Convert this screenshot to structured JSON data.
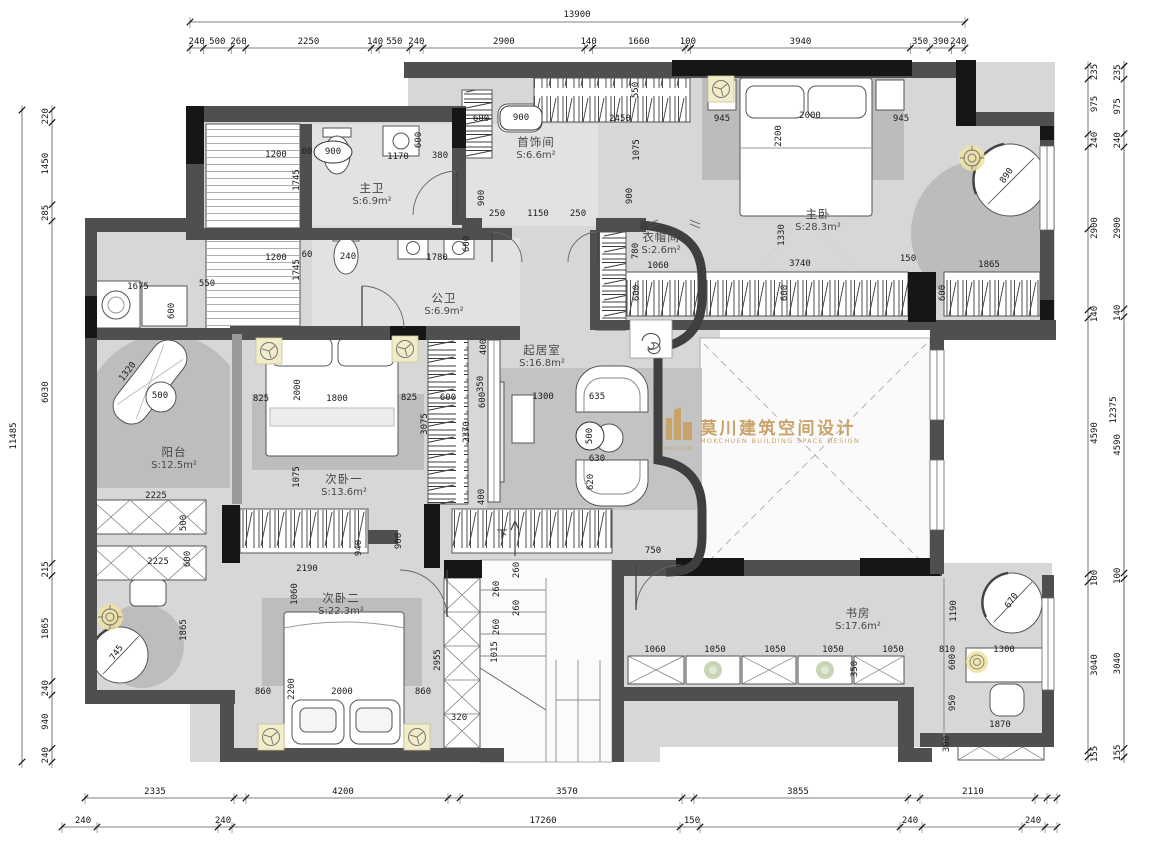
{
  "watermark": {
    "cn": "莫川建筑空间设计",
    "en": "MOKCHUEN BUILDING SPACE DESIGN",
    "logo_text": "MOKCHUEN",
    "color": "#c9a36a"
  },
  "stair_label": "下",
  "rooms": [
    {
      "name": "主卫",
      "area": "S:6.9m²",
      "x": 372,
      "y": 195
    },
    {
      "name": "首饰间",
      "area": "S:6.6m²",
      "x": 536,
      "y": 149
    },
    {
      "name": "主卧",
      "area": "S:28.3m²",
      "x": 818,
      "y": 221
    },
    {
      "name": "衣帽间",
      "area": "S:2.6m²",
      "x": 661,
      "y": 244
    },
    {
      "name": "公卫",
      "area": "S:6.9m²",
      "x": 444,
      "y": 305
    },
    {
      "name": "起居室",
      "area": "S:16.8m²",
      "x": 542,
      "y": 357
    },
    {
      "name": "阳台",
      "area": "S:12.5m²",
      "x": 174,
      "y": 459
    },
    {
      "name": "次卧一",
      "area": "S:13.6m²",
      "x": 344,
      "y": 486
    },
    {
      "name": "次卧二",
      "area": "S:22.3m²",
      "x": 341,
      "y": 605
    },
    {
      "name": "书房",
      "area": "S:17.6m²",
      "x": 858,
      "y": 620
    }
  ],
  "dims": {
    "top_total": "13900",
    "top": [
      "240",
      "500",
      "260",
      "2250",
      "140",
      "550",
      "240",
      "2900",
      "140",
      "1660",
      "100",
      "3940",
      "350",
      "390",
      "240"
    ],
    "left_total": "11485",
    "left": [
      "220",
      "1450",
      "285",
      "6030",
      "215",
      "1865",
      "240",
      "940",
      "240"
    ],
    "right_total": "12375",
    "right": [
      "235",
      "975",
      "240",
      "2900",
      "140",
      "4590",
      "100",
      "3040",
      "155"
    ],
    "bottom_row1": [
      {
        "t": "2335",
        "x": 155
      },
      {
        "t": "4200",
        "x": 343
      },
      {
        "t": "3570",
        "x": 567
      },
      {
        "t": "3855",
        "x": 798
      },
      {
        "t": "2110",
        "x": 973
      }
    ],
    "bottom_row2": [
      {
        "t": "240",
        "x": 83
      },
      {
        "t": "240",
        "x": 223
      },
      {
        "t": "17260",
        "x": 543
      },
      {
        "t": "150",
        "x": 692
      },
      {
        "t": "240",
        "x": 910
      },
      {
        "t": "240",
        "x": 1033
      }
    ]
  },
  "inner_dims": [
    {
      "t": "1200",
      "x": 276,
      "y": 155
    },
    {
      "t": "60",
      "x": 307,
      "y": 152
    },
    {
      "t": "900",
      "x": 333,
      "y": 152
    },
    {
      "t": "1170",
      "x": 398,
      "y": 157
    },
    {
      "t": "380",
      "x": 440,
      "y": 156
    },
    {
      "t": "600",
      "x": 419,
      "y": 140,
      "r": -90
    },
    {
      "t": "1745",
      "x": 297,
      "y": 180,
      "r": -90
    },
    {
      "t": "900",
      "x": 482,
      "y": 198,
      "r": -90
    },
    {
      "t": "250",
      "x": 497,
      "y": 214
    },
    {
      "t": "1150",
      "x": 538,
      "y": 214
    },
    {
      "t": "250",
      "x": 578,
      "y": 214
    },
    {
      "t": "600",
      "x": 481,
      "y": 119
    },
    {
      "t": "900",
      "x": 521,
      "y": 118
    },
    {
      "t": "2450",
      "x": 620,
      "y": 119
    },
    {
      "t": "550",
      "x": 636,
      "y": 90,
      "r": -90
    },
    {
      "t": "1075",
      "x": 637,
      "y": 150,
      "r": -90
    },
    {
      "t": "945",
      "x": 722,
      "y": 119
    },
    {
      "t": "2000",
      "x": 810,
      "y": 116
    },
    {
      "t": "945",
      "x": 901,
      "y": 119
    },
    {
      "t": "2200",
      "x": 779,
      "y": 136,
      "r": -90
    },
    {
      "t": "1200",
      "x": 276,
      "y": 258
    },
    {
      "t": "60",
      "x": 307,
      "y": 255
    },
    {
      "t": "240",
      "x": 348,
      "y": 257
    },
    {
      "t": "1780",
      "x": 437,
      "y": 258
    },
    {
      "t": "600",
      "x": 467,
      "y": 244,
      "r": -90
    },
    {
      "t": "1745",
      "x": 297,
      "y": 270,
      "r": -90
    },
    {
      "t": "1675",
      "x": 138,
      "y": 287
    },
    {
      "t": "550",
      "x": 207,
      "y": 284
    },
    {
      "t": "600",
      "x": 172,
      "y": 311,
      "r": -90
    },
    {
      "t": "900",
      "x": 630,
      "y": 196,
      "r": -90
    },
    {
      "t": "780",
      "x": 636,
      "y": 251,
      "r": -90
    },
    {
      "t": "1060",
      "x": 658,
      "y": 266
    },
    {
      "t": "1330",
      "x": 782,
      "y": 235,
      "r": -90
    },
    {
      "t": "3740",
      "x": 800,
      "y": 264
    },
    {
      "t": "150",
      "x": 908,
      "y": 259
    },
    {
      "t": "1865",
      "x": 989,
      "y": 265
    },
    {
      "t": "600",
      "x": 637,
      "y": 293,
      "r": -90
    },
    {
      "t": "600",
      "x": 785,
      "y": 293,
      "r": -90
    },
    {
      "t": "600",
      "x": 943,
      "y": 293,
      "r": -90
    },
    {
      "t": "890",
      "x": 1007,
      "y": 176,
      "r": -55
    },
    {
      "t": "400",
      "x": 484,
      "y": 347,
      "r": -90
    },
    {
      "t": "350",
      "x": 481,
      "y": 384,
      "r": -90
    },
    {
      "t": "825",
      "x": 409,
      "y": 398
    },
    {
      "t": "600",
      "x": 448,
      "y": 398
    },
    {
      "t": "600",
      "x": 483,
      "y": 400,
      "r": -90
    },
    {
      "t": "3075",
      "x": 425,
      "y": 424,
      "r": -90
    },
    {
      "t": "2370",
      "x": 467,
      "y": 432,
      "r": -90
    },
    {
      "t": "1300",
      "x": 543,
      "y": 397
    },
    {
      "t": "635",
      "x": 597,
      "y": 397
    },
    {
      "t": "500",
      "x": 590,
      "y": 436,
      "r": -90
    },
    {
      "t": "630",
      "x": 597,
      "y": 459
    },
    {
      "t": "620",
      "x": 591,
      "y": 482,
      "r": -90
    },
    {
      "t": "400",
      "x": 482,
      "y": 497,
      "r": -90
    },
    {
      "t": "1320",
      "x": 128,
      "y": 372,
      "r": -52
    },
    {
      "t": "500",
      "x": 160,
      "y": 396
    },
    {
      "t": "2225",
      "x": 156,
      "y": 496
    },
    {
      "t": "500",
      "x": 184,
      "y": 523,
      "r": -90
    },
    {
      "t": "2225",
      "x": 158,
      "y": 562
    },
    {
      "t": "600",
      "x": 188,
      "y": 559,
      "r": -90
    },
    {
      "t": "1865",
      "x": 184,
      "y": 630,
      "r": -90
    },
    {
      "t": "745",
      "x": 117,
      "y": 653,
      "r": -55
    },
    {
      "t": "825",
      "x": 261,
      "y": 399
    },
    {
      "t": "2000",
      "x": 298,
      "y": 390,
      "r": -90
    },
    {
      "t": "1800",
      "x": 337,
      "y": 399
    },
    {
      "t": "1075",
      "x": 297,
      "y": 477,
      "r": -90
    },
    {
      "t": "2190",
      "x": 307,
      "y": 569
    },
    {
      "t": "1060",
      "x": 295,
      "y": 594,
      "r": -90
    },
    {
      "t": "940",
      "x": 359,
      "y": 548,
      "r": -90
    },
    {
      "t": "900",
      "x": 399,
      "y": 541,
      "r": -90
    },
    {
      "t": "260",
      "x": 517,
      "y": 570,
      "r": -90
    },
    {
      "t": "260",
      "x": 497,
      "y": 589,
      "r": -90
    },
    {
      "t": "260",
      "x": 517,
      "y": 608,
      "r": -90
    },
    {
      "t": "260",
      "x": 497,
      "y": 627,
      "r": -90
    },
    {
      "t": "1015",
      "x": 495,
      "y": 652,
      "r": -90
    },
    {
      "t": "750",
      "x": 653,
      "y": 551
    },
    {
      "t": "2955",
      "x": 438,
      "y": 660,
      "r": -90
    },
    {
      "t": "320",
      "x": 459,
      "y": 718
    },
    {
      "t": "860",
      "x": 263,
      "y": 692
    },
    {
      "t": "2200",
      "x": 292,
      "y": 689,
      "r": -90
    },
    {
      "t": "2000",
      "x": 342,
      "y": 692
    },
    {
      "t": "860",
      "x": 423,
      "y": 692
    },
    {
      "t": "1060",
      "x": 655,
      "y": 650
    },
    {
      "t": "1050",
      "x": 715,
      "y": 650
    },
    {
      "t": "1050",
      "x": 775,
      "y": 650
    },
    {
      "t": "1050",
      "x": 833,
      "y": 650
    },
    {
      "t": "1050",
      "x": 893,
      "y": 650
    },
    {
      "t": "810",
      "x": 947,
      "y": 650
    },
    {
      "t": "350",
      "x": 855,
      "y": 669,
      "r": -90
    },
    {
      "t": "1190",
      "x": 954,
      "y": 611,
      "r": -90
    },
    {
      "t": "600",
      "x": 953,
      "y": 662,
      "r": -90
    },
    {
      "t": "1300",
      "x": 1004,
      "y": 650
    },
    {
      "t": "950",
      "x": 953,
      "y": 703,
      "r": -90
    },
    {
      "t": "1870",
      "x": 1000,
      "y": 725
    },
    {
      "t": "300",
      "x": 947,
      "y": 744,
      "r": -90
    },
    {
      "t": "670",
      "x": 1012,
      "y": 601,
      "r": -55
    }
  ],
  "icons": [
    {
      "name": "ceiling-fan-icon",
      "count": 5
    },
    {
      "name": "ceiling-light-icon",
      "count": 3
    },
    {
      "name": "towel-spiral-icon",
      "count": 1
    },
    {
      "name": "downlight-icon",
      "count": 2
    },
    {
      "name": "stair-up-arrow-icon",
      "count": 1
    }
  ],
  "colors": {
    "wall": "#4f4f4f",
    "wall_dark": "#161616",
    "floor": "#d7d7d7",
    "rug": "#bcbcbc",
    "accent_glow": "#f3ecc9",
    "watermark": "#c9a36a"
  }
}
